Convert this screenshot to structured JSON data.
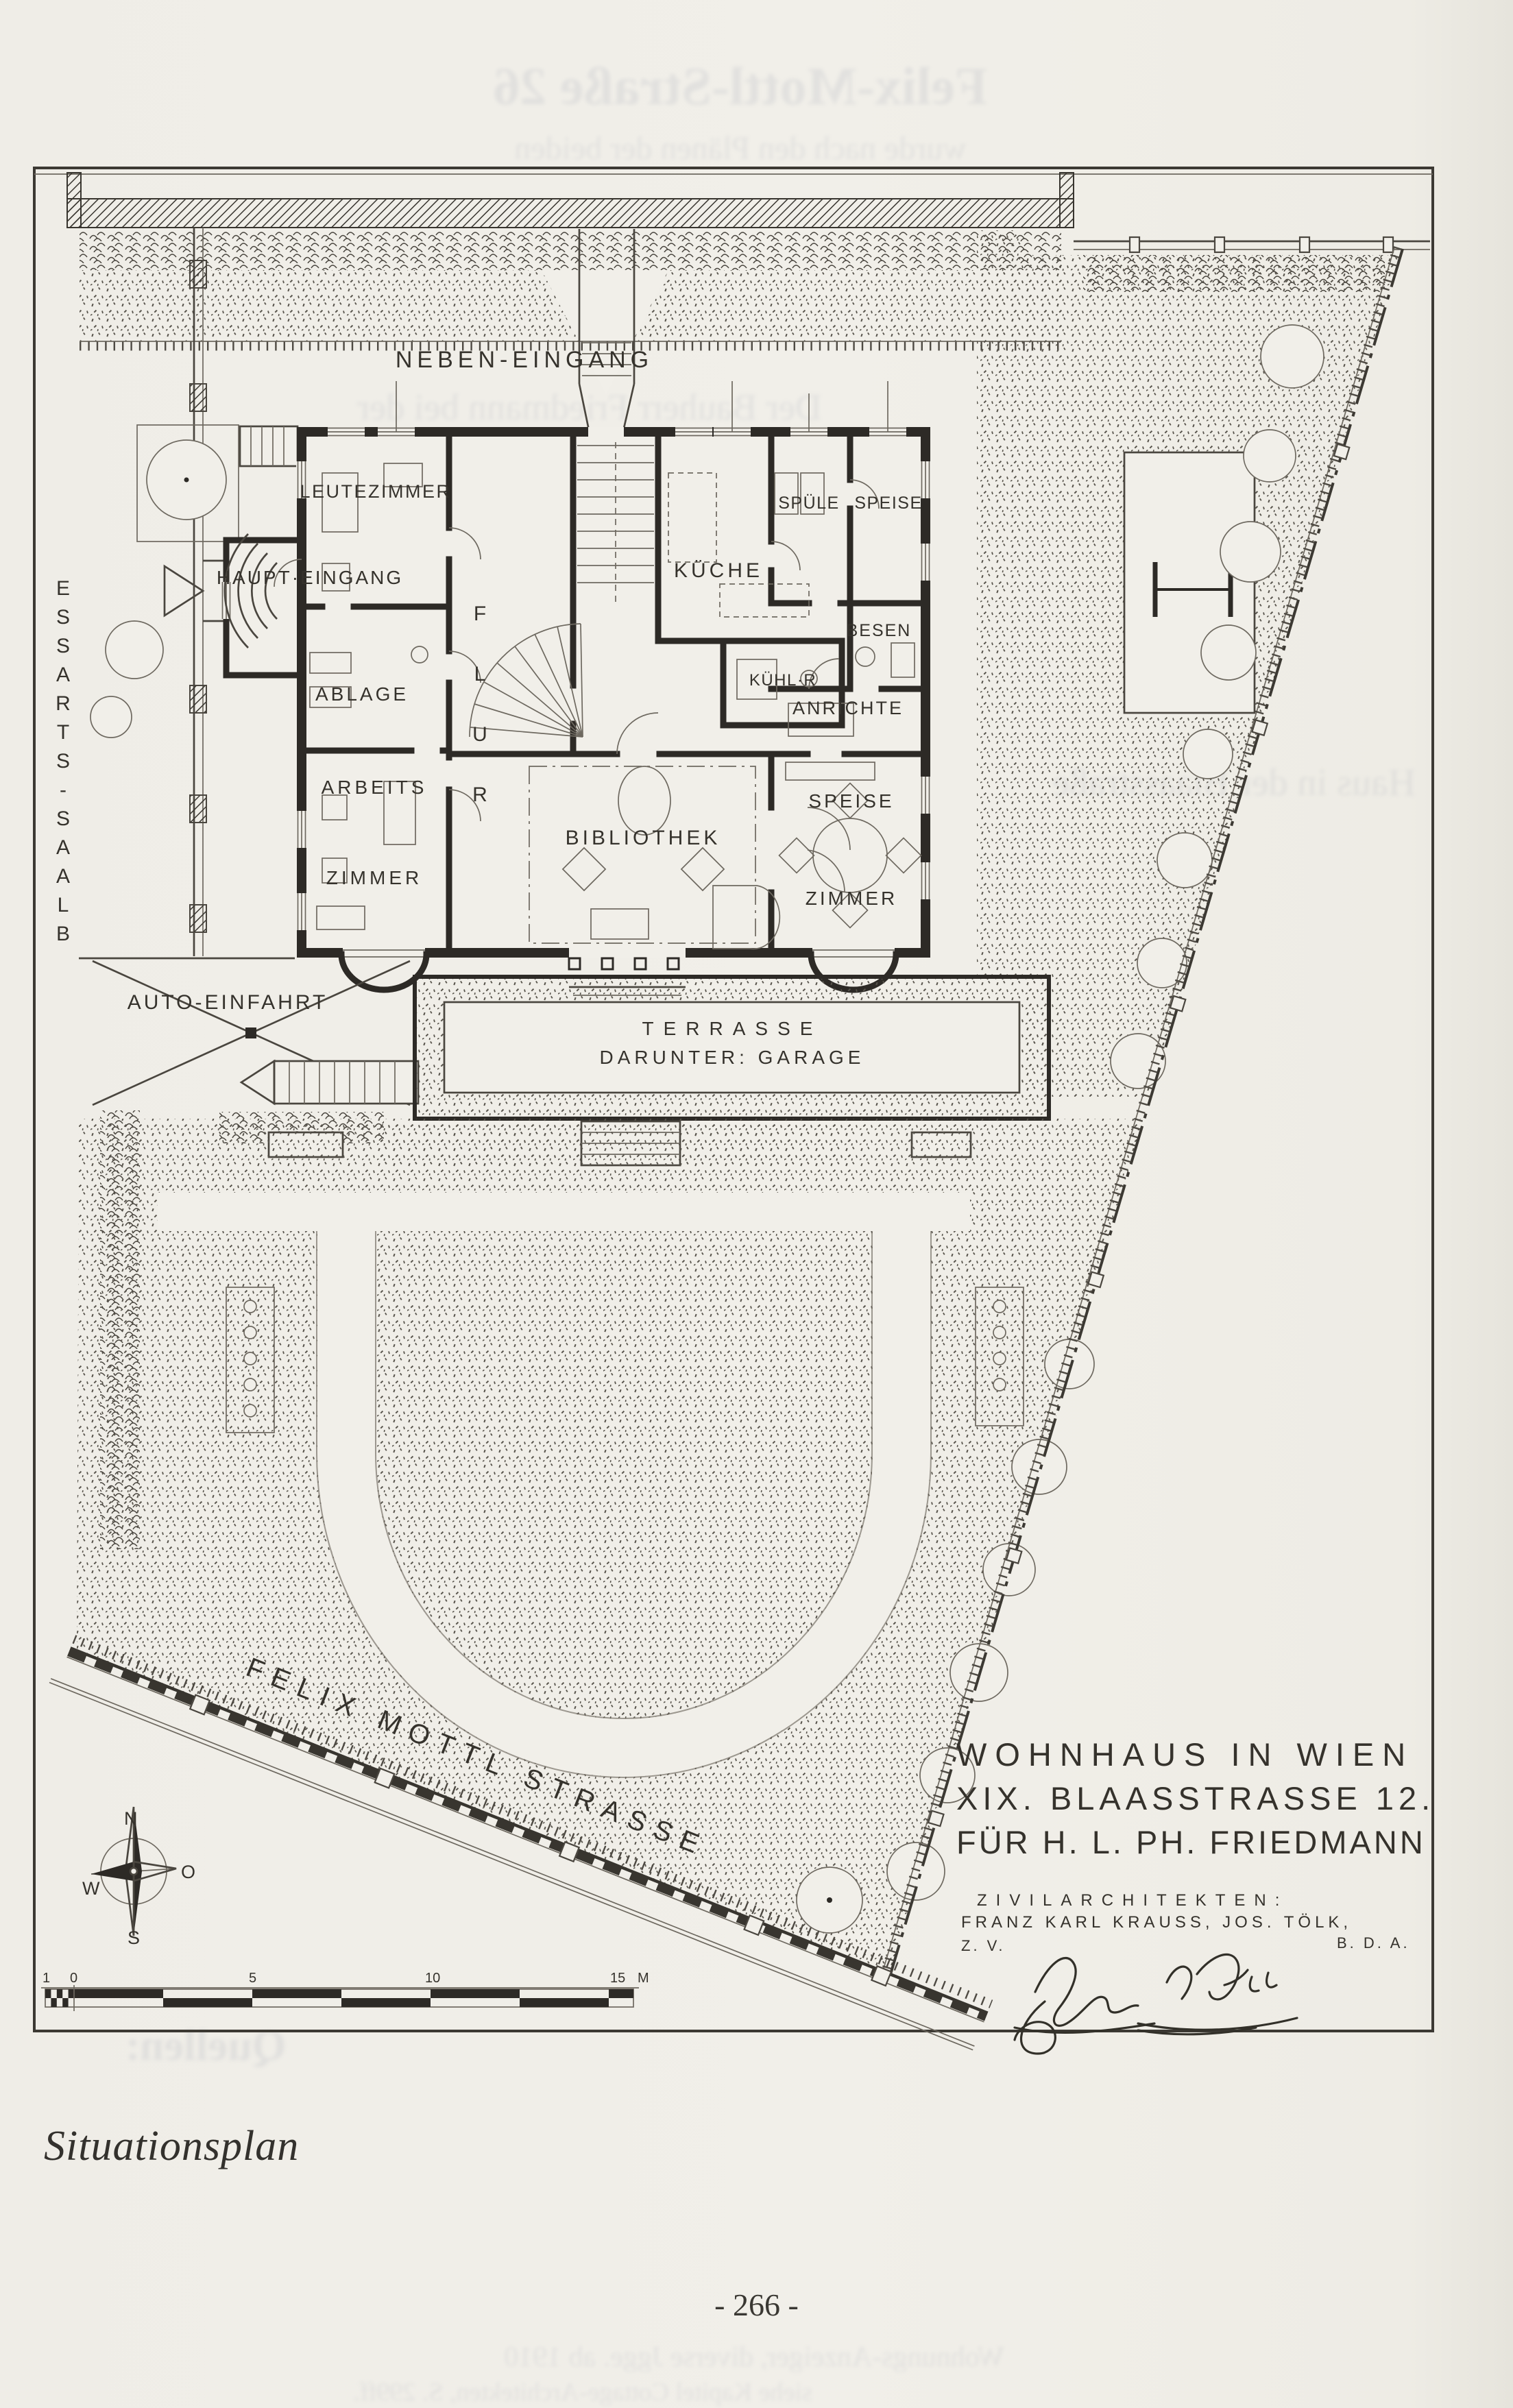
{
  "document": {
    "caption": "Situationsplan",
    "page_number": "- 266 -"
  },
  "plan": {
    "rooms": {
      "neben_eingang": "NEBEN-EINGANG",
      "leutezimmer": "LEUTEZIMMER",
      "haupt_eingang": "HAUPT·EINGANG",
      "ablage": "ABLAGE",
      "arbeits_line1": "ARBEITS",
      "arbeits_line2": "ZIMMER",
      "flur": "FLUR",
      "kueche": "KÜCHE",
      "kuehlraum": "KÜHL·R",
      "spuele": "SPÜLE",
      "speisekammer": "SPEISE",
      "besen": "BESEN",
      "anrichte": "ANRICHTE",
      "bibliothek": "BIBLIOTHEK",
      "speisezimmer_line1": "SPEISE",
      "speisezimmer_line2": "ZIMMER"
    },
    "site": {
      "auto_einfahrt": "AUTO-EINFAHRT",
      "terrasse_line1": "TERRASSE",
      "terrasse_line2": "DARUNTER: GARAGE",
      "blaas_strasse": "BLAAS-STRASSE",
      "felix_mottl_strasse": "FELIX MOTTL STRASSE"
    },
    "title_block": {
      "line1": "WOHNHAUS IN WIEN",
      "line2": "XIX. BLAASSTRASSE 12.",
      "line3": "FÜR H. L. PH. FRIEDMANN",
      "architects_label": "ZIVILARCHITEKTEN:",
      "architects_names": "FRANZ KARL KRAUSS, JOS. TÖLK,",
      "architects_assoc1": "B. D. A.",
      "architects_assoc2": "Z. V."
    },
    "compass": {
      "north": "N",
      "east": "O",
      "south": "S",
      "west": "W"
    },
    "scale_bar": {
      "labels": [
        "1",
        "0",
        "5",
        "10",
        "15",
        "M"
      ]
    }
  },
  "ghost_text": {
    "lines": [
      "Felix-Mottl-Straße 26",
      "wurde nach den Plänen der beiden",
      "Der Bauherr Friedmann bei der",
      "Errichtung des Hauses wurde",
      "Haus in der Blaasstraße",
      "Quellen:",
      "Wohnungs-Anzeiger, diverse Jgge. ab 1910",
      "siehe Kapitel Cottage-Architekten, S. 299ff."
    ]
  }
}
